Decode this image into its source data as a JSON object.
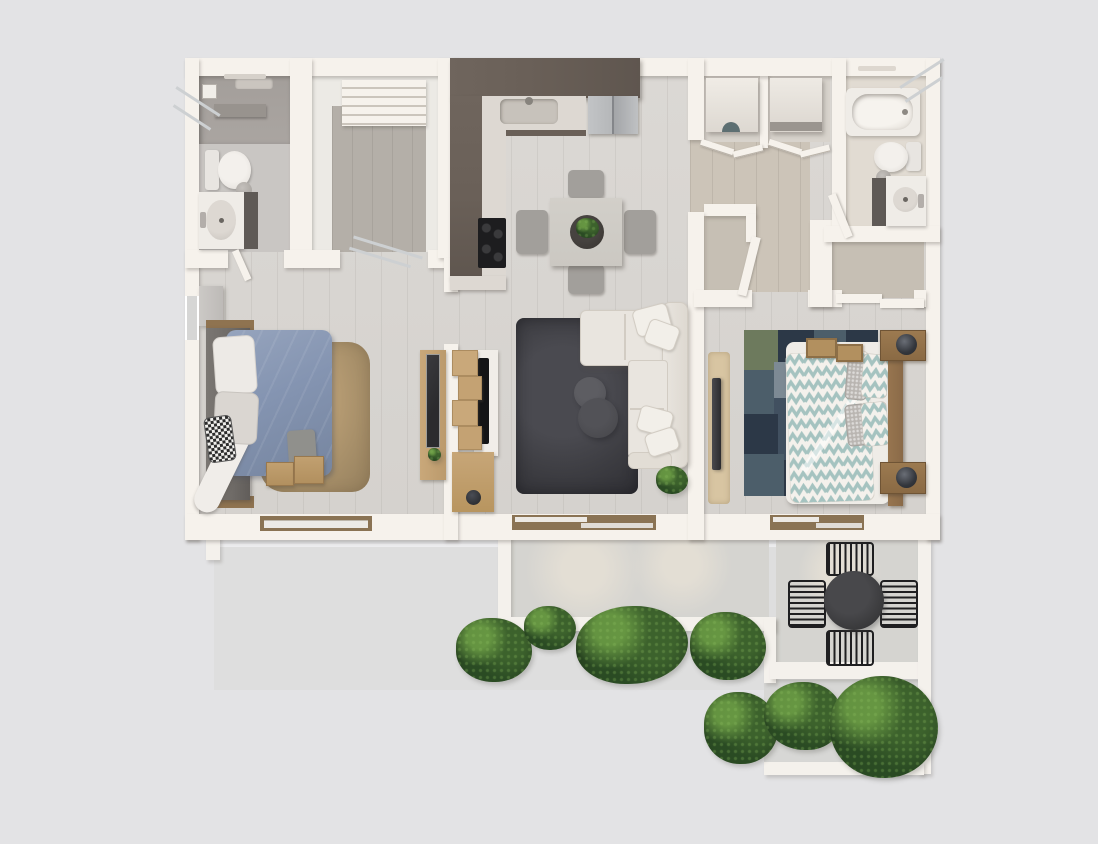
{
  "scene": {
    "title": "Two-bedroom apartment floor plan with terrace",
    "style": "photorealistic 3D top-down render",
    "visible_text": "none",
    "canvas": {
      "width": 1098,
      "height": 844
    }
  },
  "palette": {
    "bg": "#e3e3e5",
    "wall": "#f6f2ec",
    "wallDim": "#eceae5",
    "floor": "#d9d6d2",
    "entryFloor": "#b4afa8",
    "corridorFloor": "#ccc4b8",
    "closetFloor": "#c6bfb4",
    "bathFloor": "#c9c6c3",
    "showerFloor": "#aaa5a1",
    "bath2Floor": "#e1dbd2",
    "kitchenDark": "#6a6058",
    "counter": "#ddd8d2",
    "steel": "#b5b7b9",
    "stove": "#1d1d1f",
    "tableWood": "#cbc8c2",
    "chairGray": "#a29f9b",
    "sofa": "#e9e5df",
    "sofaLine": "#d2ccc3",
    "pillow": "#f2efe9",
    "rugDark": "#3d3d42",
    "rugBrown": "#a8906a",
    "bedBlue": "#8494b1",
    "sheet": "#f0ede9",
    "headboard": "#6f6b67",
    "throwGray": "#90908c",
    "wood": "#b2905f",
    "woodLight": "#c9a87a",
    "woodDark": "#8a6a48",
    "chevTeal": "#a5c3c0",
    "chevWhite": "#f4f1ec",
    "patchBase": "#415060",
    "patch1": "#2c3847",
    "patch2": "#4c5e6a",
    "patch3": "#6d7a5d",
    "patch4": "#7d8a94",
    "runner": "#d8c5a2",
    "mirror": "#2b2b2e",
    "tv": "#141416",
    "concrete": "#d5d4d0",
    "slab": "#dedede",
    "parapet": "#f4f1ec",
    "shrubDark": "#1e3518",
    "shrubMid": "#2c4a24",
    "shrubLight": "#55803a",
    "metal": "#1f1f21",
    "bistro": "#3a3a3c",
    "lamp": "#33363c",
    "porcelain": "#efece7",
    "fixture": "#5f5a56",
    "glass": "#cdd0d2",
    "frame": "#8a7354"
  },
  "rooms": {
    "bathroom1": {
      "label": "Bathroom 1",
      "items": [
        "walk-in shower",
        "shower glass door",
        "toilet",
        "vanity with sink",
        "trash bin",
        "towel bar"
      ]
    },
    "entry": {
      "label": "Entry stair hall",
      "items": [
        "staircase",
        "door swing"
      ]
    },
    "kitchen": {
      "label": "Kitchen",
      "items": [
        "L-shaped dark wood cabinets",
        "sink",
        "refrigerator",
        "cooktop"
      ]
    },
    "dining": {
      "label": "Dining area",
      "items": [
        "square table",
        "four chairs",
        "centerpiece plant"
      ]
    },
    "living": {
      "label": "Living room",
      "items": [
        "L-shaped sectional sofa",
        "throw pillows",
        "two round coffee tables",
        "dark shag rug",
        "media wall with TV",
        "wood shelf boxes",
        "potted plant",
        "sliding door to terrace"
      ]
    },
    "bedroom1": {
      "label": "Bedroom 1",
      "items": [
        "double bed with blue duvet",
        "storage headboard",
        "pillows",
        "patterned accent pillow",
        "brown shag rug",
        "two wood ottomans",
        "wall shelf",
        "side window",
        "desk with mirror"
      ]
    },
    "bedroom2": {
      "label": "Bedroom 2",
      "items": [
        "double bed with chevron duvet",
        "chevron pillows",
        "gray pillows",
        "wood headboard",
        "two nightstands with lamps",
        "patchwork rug",
        "leaning floor mirror",
        "runner rug",
        "two serving trays",
        "sliding-door closet",
        "sliding door to terrace"
      ]
    },
    "bathroom2": {
      "label": "Bathroom 2",
      "items": [
        "bathtub",
        "glass screen",
        "toilet",
        "vanity with round sink",
        "trash bin",
        "door"
      ]
    },
    "laundry": {
      "label": "Laundry closets",
      "items": [
        "washer",
        "dryer",
        "bifold doors"
      ]
    },
    "hallCloset": {
      "label": "Hall closet",
      "items": [
        "hinged door"
      ]
    },
    "corridor": {
      "label": "Hallway",
      "items": [
        "bedroom 2 door"
      ]
    },
    "balcony": {
      "label": "Terrace / balcony",
      "items": [
        "parapet railing",
        "bistro table",
        "four metal slat chairs",
        "boxwood shrubs",
        "lower planting terrace"
      ]
    }
  }
}
